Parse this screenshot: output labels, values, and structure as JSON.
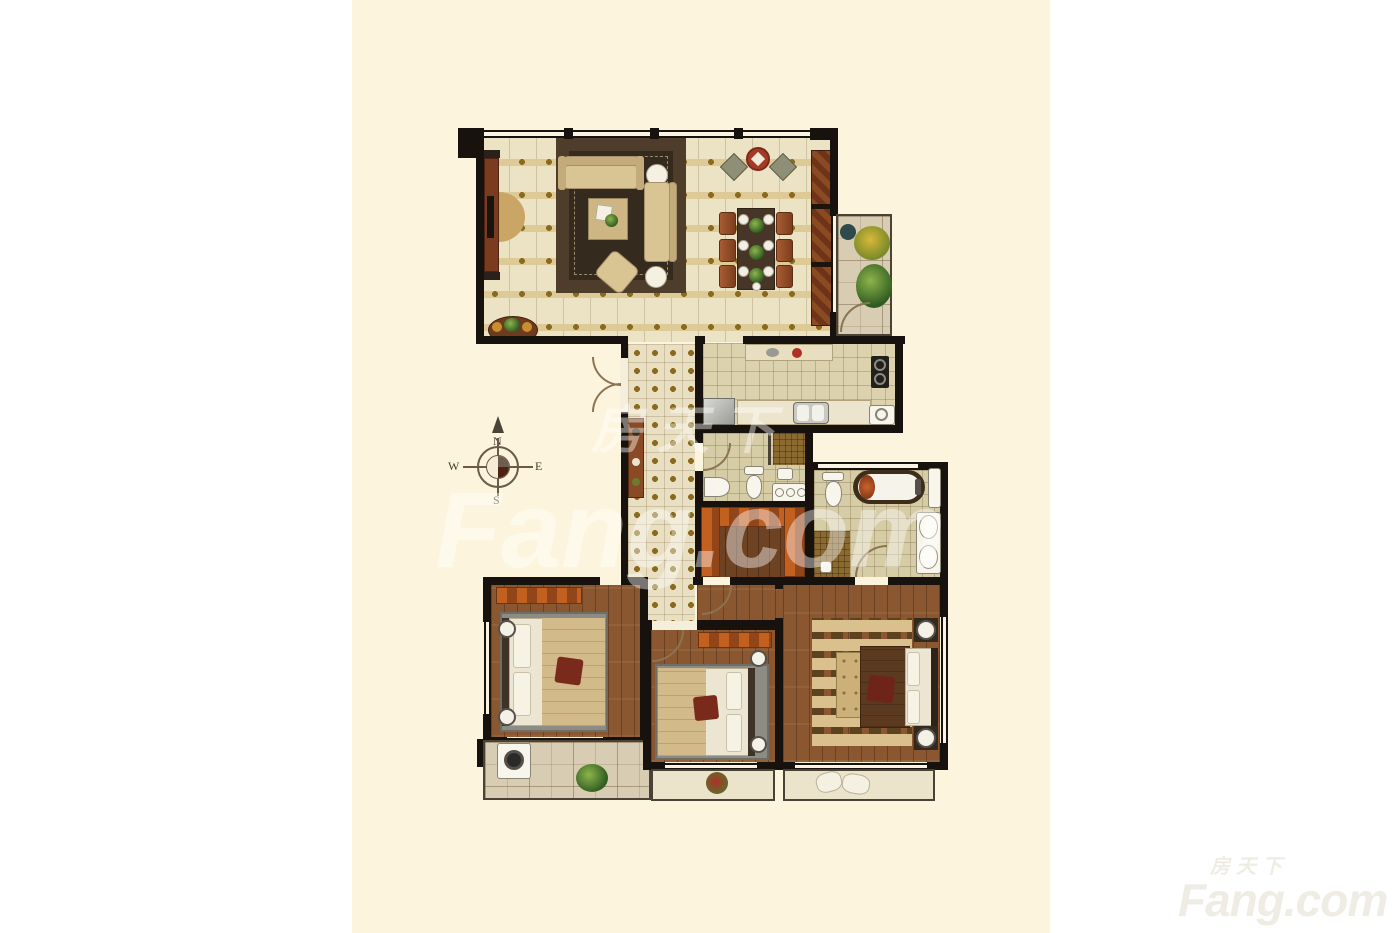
{
  "compass": {
    "north": "N",
    "east": "E",
    "south": "S",
    "west": "W"
  },
  "watermark": {
    "brand_cn": "房天下",
    "brand_en": "Fang.com"
  },
  "palette": {
    "page_background": "#ffffff",
    "sheet": "#fcf4dc",
    "wall": "#17120d",
    "wood_floor": "#8a5730",
    "tile_floor": "#e9dfc2",
    "stone_floor": "#d8cdb2",
    "living_floor": "#ece2c4",
    "rug_dark": "#3c2f21",
    "accent_orange": "#b5541c",
    "fixture_white": "#f7f5ec",
    "gold_accent": "#8f6f1d",
    "watermark_gray": "#efece4"
  }
}
